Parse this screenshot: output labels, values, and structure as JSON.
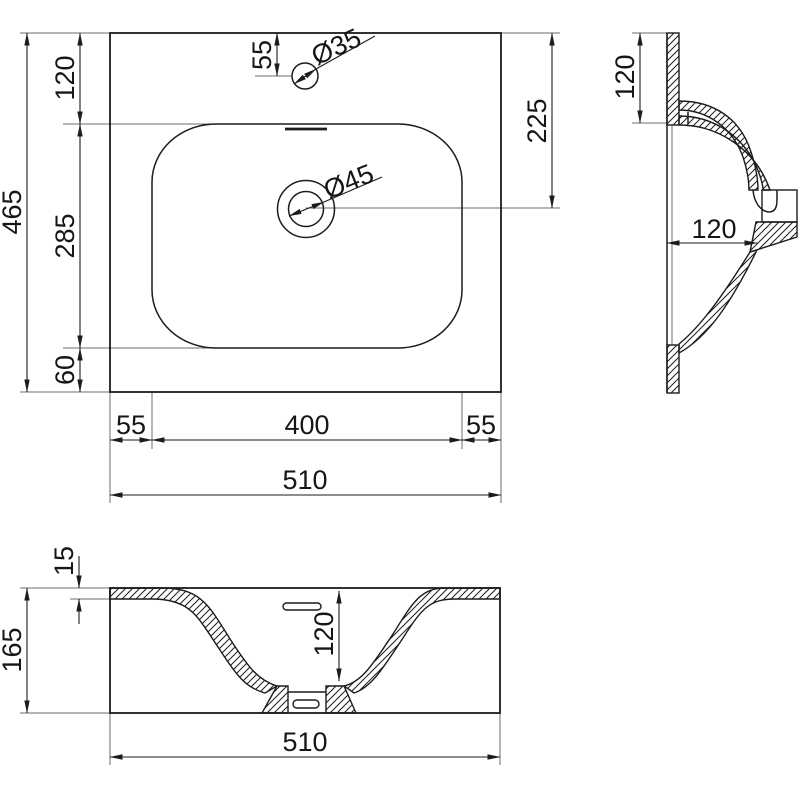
{
  "colors": {
    "line": "#1c1c1c",
    "background": "#ffffff",
    "extension_line": "#6d6d6d"
  },
  "plan": {
    "height_total": "465",
    "rim_back": "120",
    "basin_length": "285",
    "rim_front": "60",
    "faucet_offset": "55",
    "faucet_dia": "Ø35",
    "drain_offset": "225",
    "drain_dia": "Ø45",
    "margin_left": "55",
    "basin_width": "400",
    "margin_right": "55",
    "width_total": "510"
  },
  "side": {
    "rim_back_width": "120",
    "bowl_depth": "120"
  },
  "front": {
    "rim_thickness": "15",
    "height_total": "165",
    "bowl_depth": "120",
    "width_total": "510"
  }
}
